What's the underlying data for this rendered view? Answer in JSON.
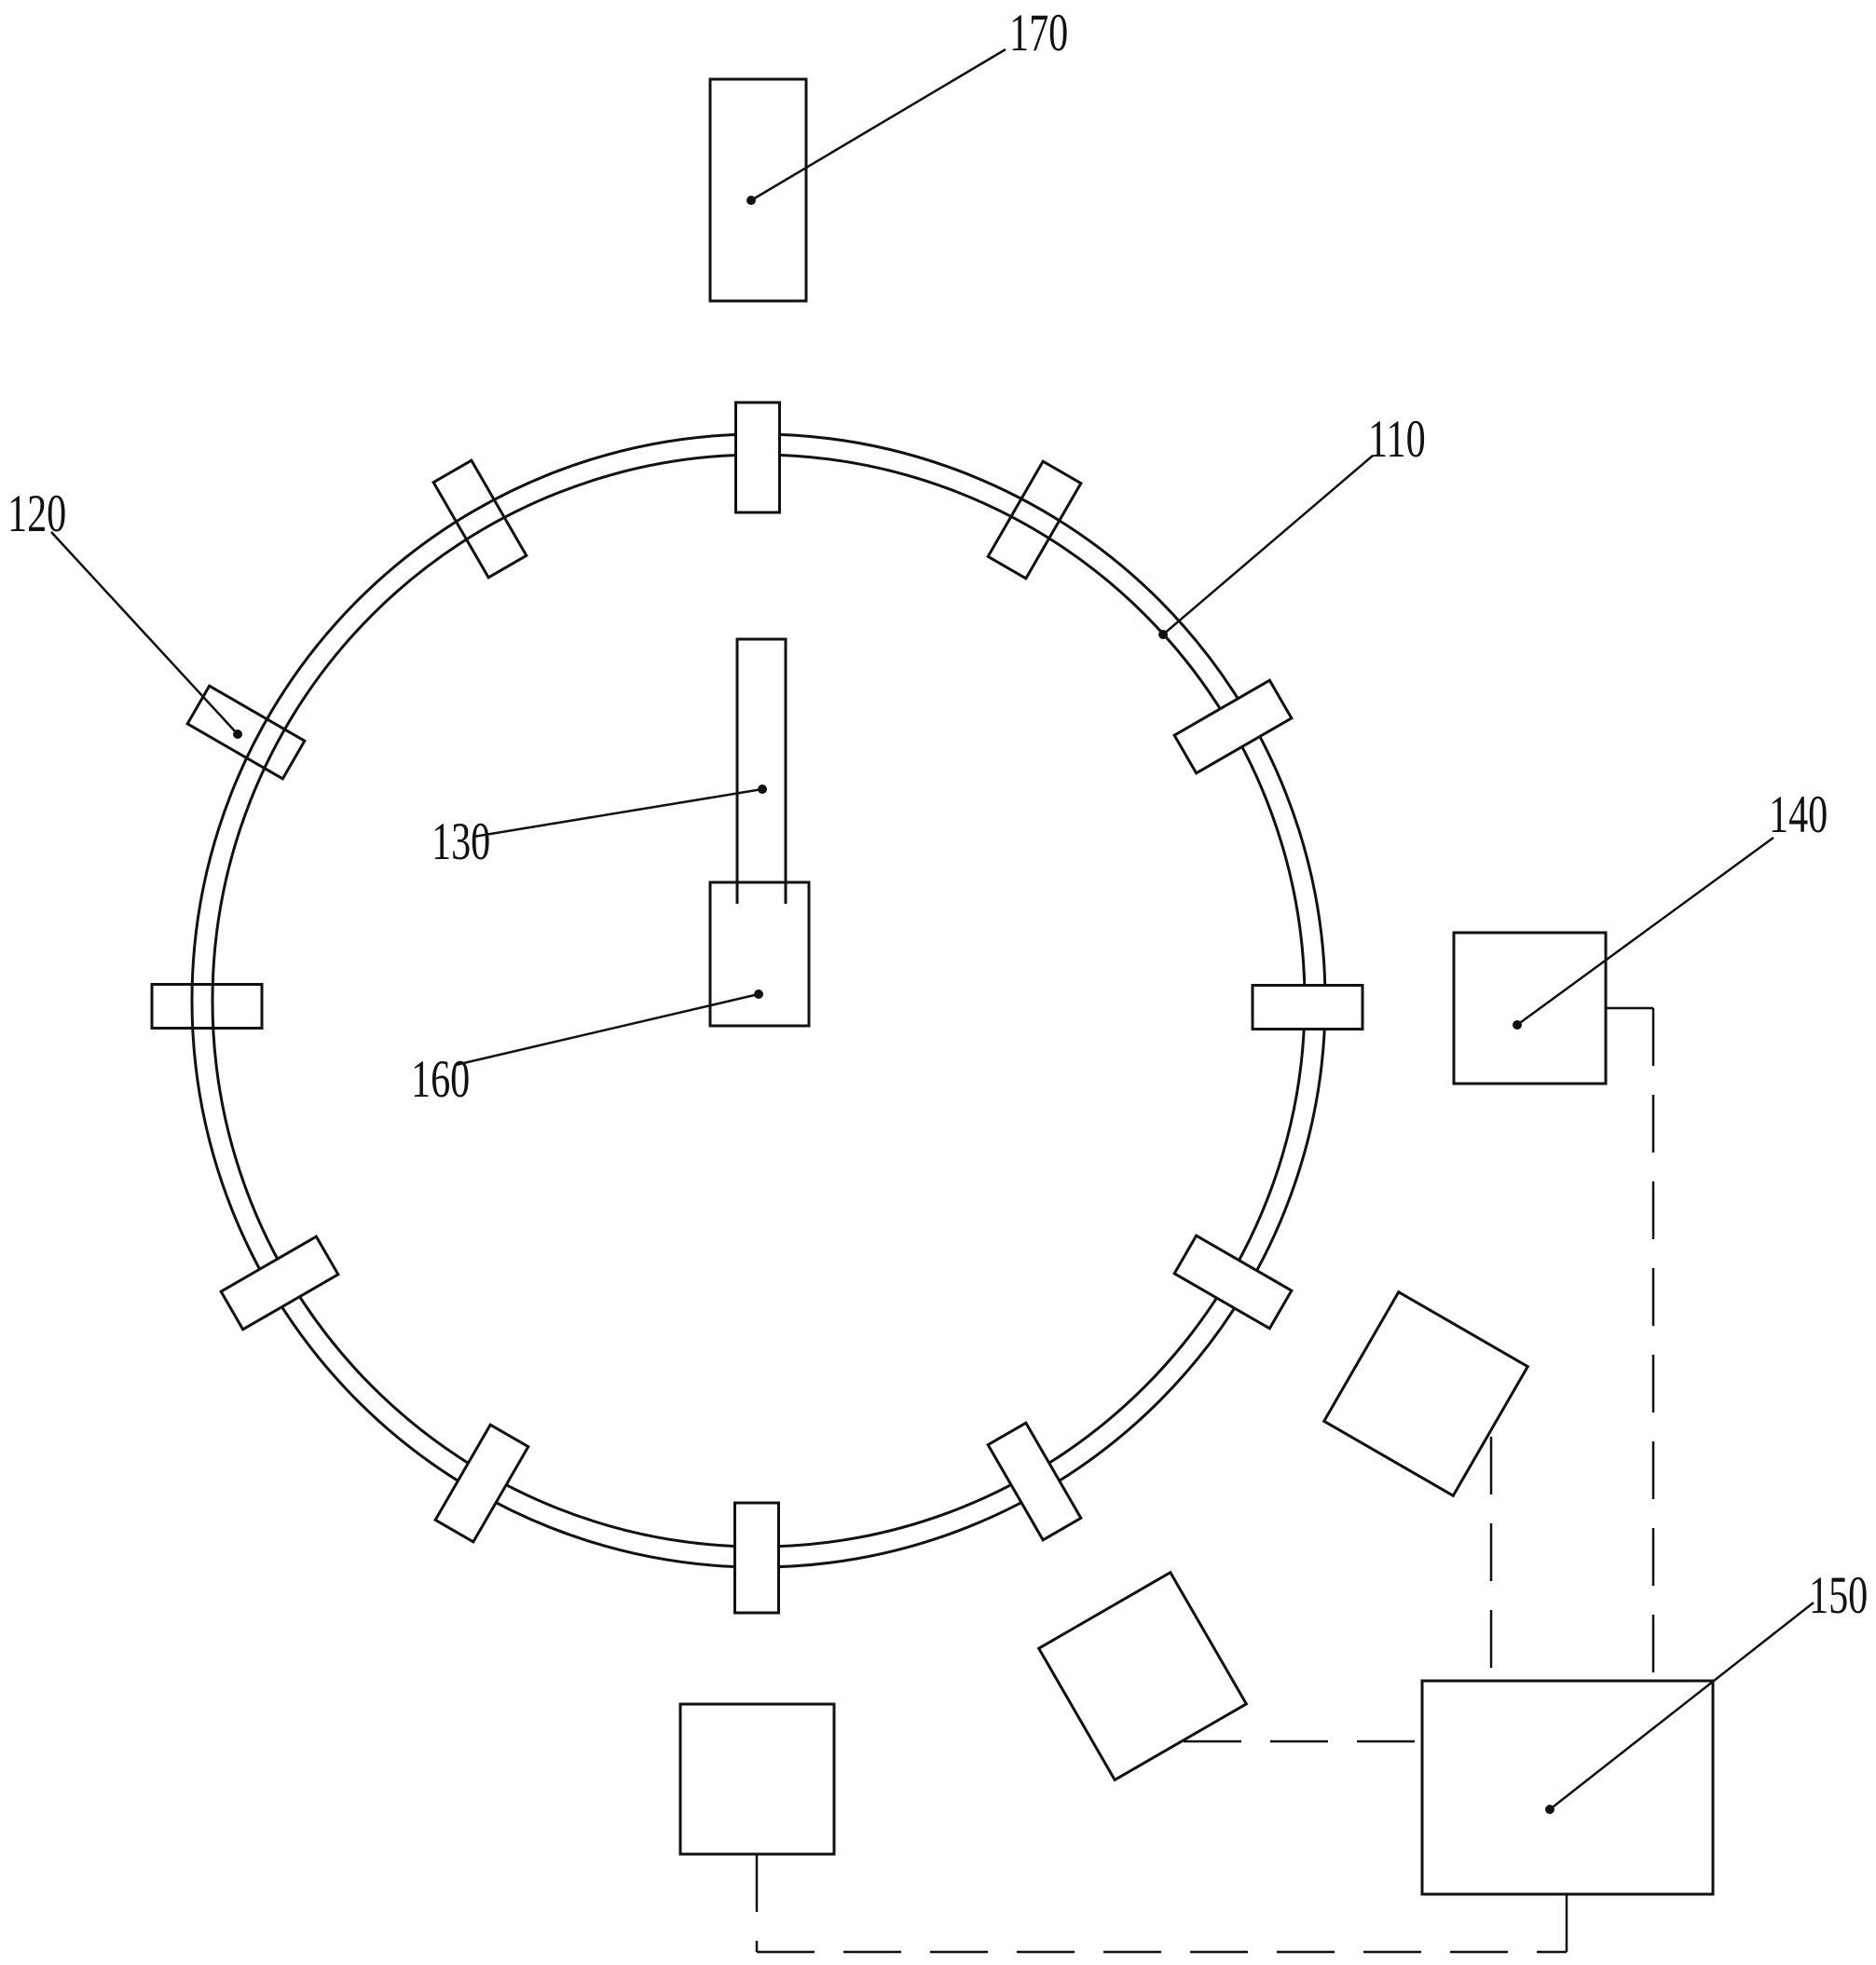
{
  "figure": {
    "background": "#ffffff",
    "line_color": "#111111",
    "labels": [
      {
        "id": "110",
        "text": "110"
      },
      {
        "id": "120",
        "text": "120"
      },
      {
        "id": "130",
        "text": "130"
      },
      {
        "id": "140",
        "text": "140"
      },
      {
        "id": "150",
        "text": "150"
      },
      {
        "id": "160",
        "text": "160"
      },
      {
        "id": "170",
        "text": "170"
      }
    ]
  }
}
